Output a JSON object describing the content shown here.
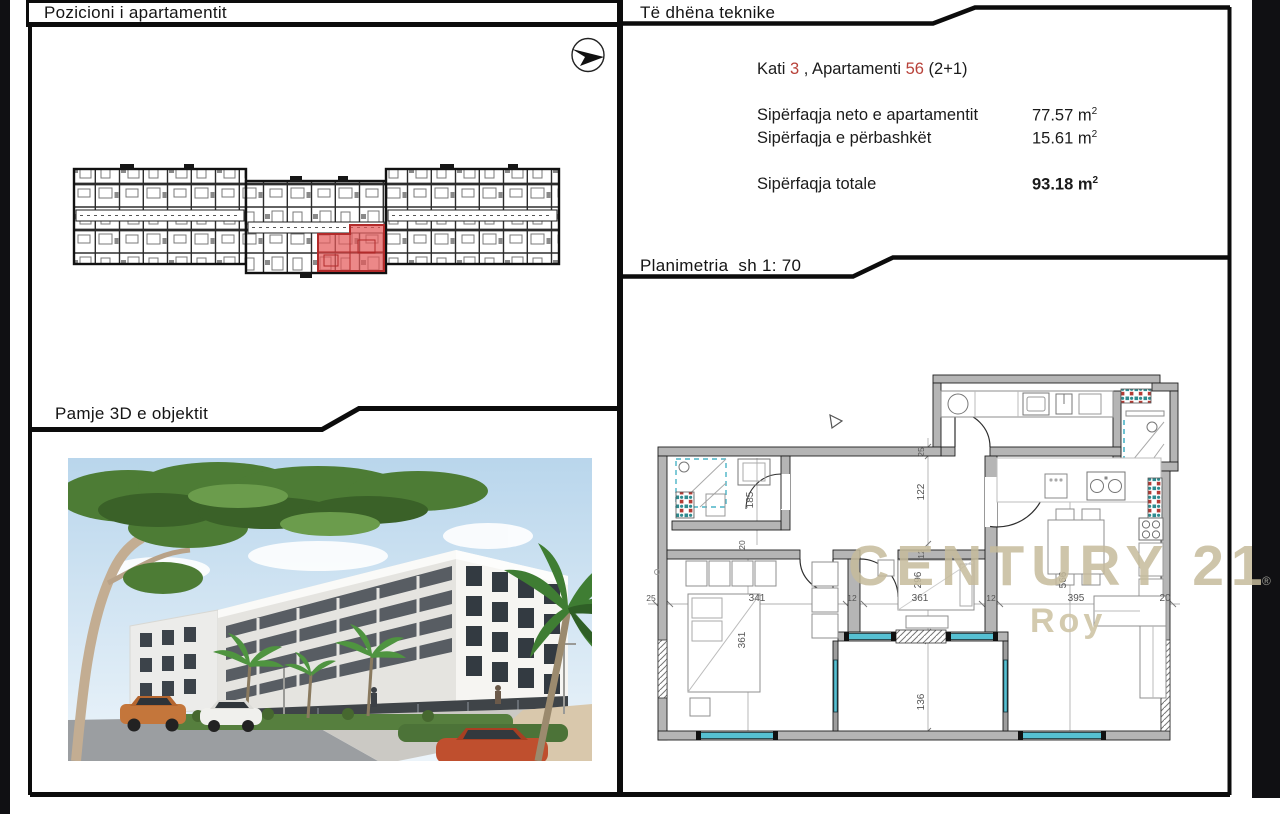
{
  "headers": {
    "position": "Pozicioni i apartamentit",
    "technical": "Të dhëna teknike",
    "plan_title": "Planimetria",
    "plan_scale": "sh 1: 70",
    "view3d": "Pamje 3D e objektit"
  },
  "technical": {
    "prefix_floor": "Kati ",
    "floor_value": "3",
    "infix_apartment": " , Apartamenti ",
    "apartment_value": "56",
    "suffix_type": " (2+1)",
    "rows": [
      {
        "label": "Sipërfaqja neto e apartamentit",
        "value": "77.57 m",
        "sup": "2"
      },
      {
        "label": "Sipërfaqja e përbashkët",
        "value": "15.61 m",
        "sup": "2"
      }
    ],
    "total": {
      "label": "Sipërfaqja totale",
      "value": "93.18 m",
      "sup": "2"
    }
  },
  "watermark": {
    "brand": "CENTURY 21",
    "registered": "®",
    "sub": "Roy"
  },
  "plan_dimensions": {
    "horizontal": [
      "25",
      "341",
      "12",
      "361",
      "12",
      "395",
      "20"
    ],
    "vertical": {
      "bathroom": "185",
      "closet_depth": "20",
      "bedroom1": "361",
      "wall_top": "25",
      "hallway": "122",
      "wall_mid": "12",
      "bedroom2": "296",
      "loggia": "136",
      "living": "566"
    }
  },
  "icons": {
    "north_arrow": "circled-arrow-east",
    "entrance_marker": "small-open-triangle"
  },
  "colors": {
    "accent_red_text": "#b8423a",
    "highlight_unit": "#e25858",
    "wall_gray": "#b5b5b5",
    "window_teal": "#4ab3c6",
    "watermark_beige": "#c7bc9d"
  }
}
